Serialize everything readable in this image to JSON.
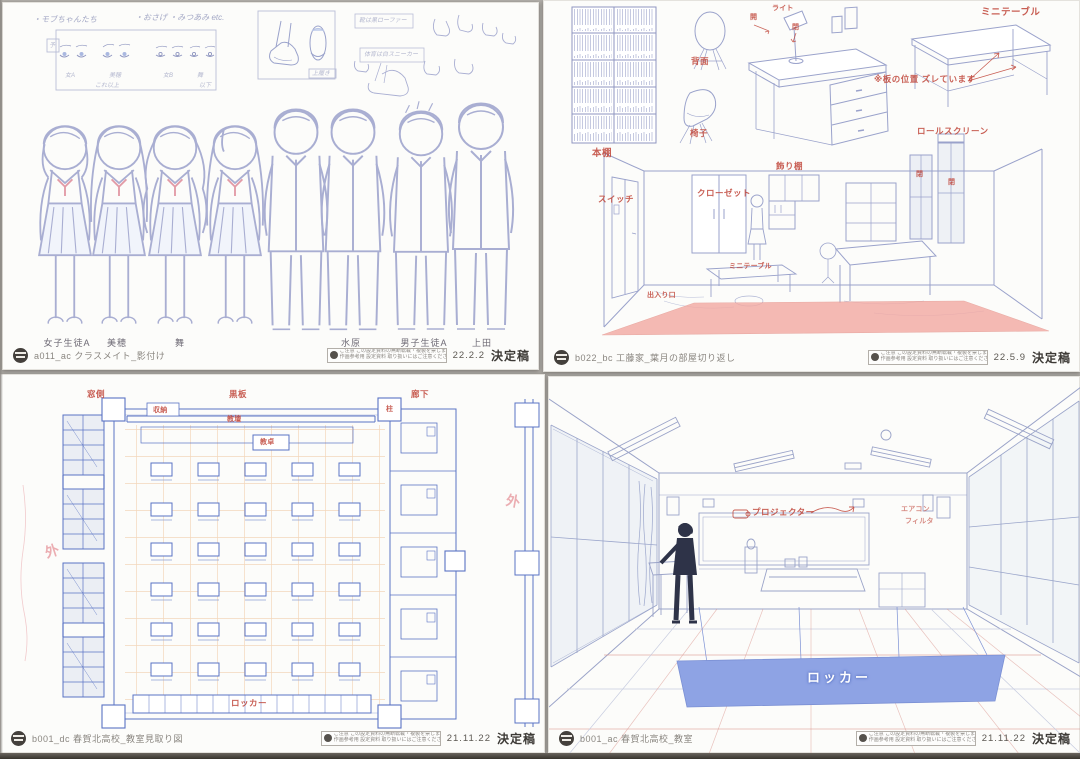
{
  "colors": {
    "red": "#bf4337",
    "plan_blue": "#5a73c4",
    "line": "#a9aed2",
    "orange_grid": "#e9b179",
    "rug_pink": "#f3a9a2",
    "locker_blue": "#8ea3e4",
    "pink_hand": "#e79aa0"
  },
  "notice": {
    "line1": "ご注意 この設定資料の無断転載・複製を禁じます",
    "line2": "作画参考用 設定資料 取り扱いにはご注意ください"
  },
  "sheets": {
    "a": {
      "footer": {
        "id": "a011_ac クラスメイト_影付け",
        "date": "22.2.2",
        "status": "決定稿"
      },
      "notes": {
        "top1": "・モブちゃんたち",
        "top2": "・おさげ ・みつあみ etc.",
        "eye_tag": "予",
        "eye_labels": [
          "女A",
          "美穂",
          "女B",
          "舞"
        ],
        "eye_cap_left": "これ以上",
        "eye_cap_right": "以下",
        "shoe_tag": "上履き",
        "box1": "靴は黒ローファー",
        "box2": "体育は白スニーカー"
      },
      "names": [
        "女子生徒A",
        "美穂",
        "舞",
        "水原",
        "男子生徒A",
        "上田"
      ]
    },
    "b": {
      "footer": {
        "id": "b022_bc 工藤家_葉月の部屋切り返し",
        "date": "22.5.9",
        "status": "決定稿"
      },
      "labels": {
        "bookshelf": "本棚",
        "back_view": "背面",
        "chair": "椅子",
        "open": "開",
        "light": "ライト",
        "closed": "閉",
        "mini_table": "ミニテーブル",
        "board_note": "※板の位置 ズレています",
        "roll_screen": "ロールスクリーン",
        "switch": "スイッチ",
        "closet": "クローゼット",
        "display_shelf": "飾り棚",
        "mini_table2": "ミニテーブル",
        "entrance": "出入り口",
        "window_closed_1": "閉",
        "window_closed_2": "閉"
      }
    },
    "c": {
      "footer": {
        "id": "b001_dc 春賀北高校_教室見取り図",
        "date": "21.11.22",
        "status": "決定稿"
      },
      "labels": {
        "window_side": "窓側",
        "blackboard": "黒板",
        "corridor": "廊下",
        "storage": "収納",
        "platform": "教壇",
        "teacher_desk": "教卓",
        "pillar": "柱",
        "outside_left": "外",
        "outside_right": "外",
        "locker": "ロッカー"
      }
    },
    "d": {
      "footer": {
        "id": "b001_ac 春賀北高校_教室",
        "date": "21.11.22",
        "status": "決定稿"
      },
      "labels": {
        "projector": "プロジェクター",
        "note1": "エアコン",
        "note2": "フィルタ",
        "locker": "ロッカー"
      }
    }
  }
}
